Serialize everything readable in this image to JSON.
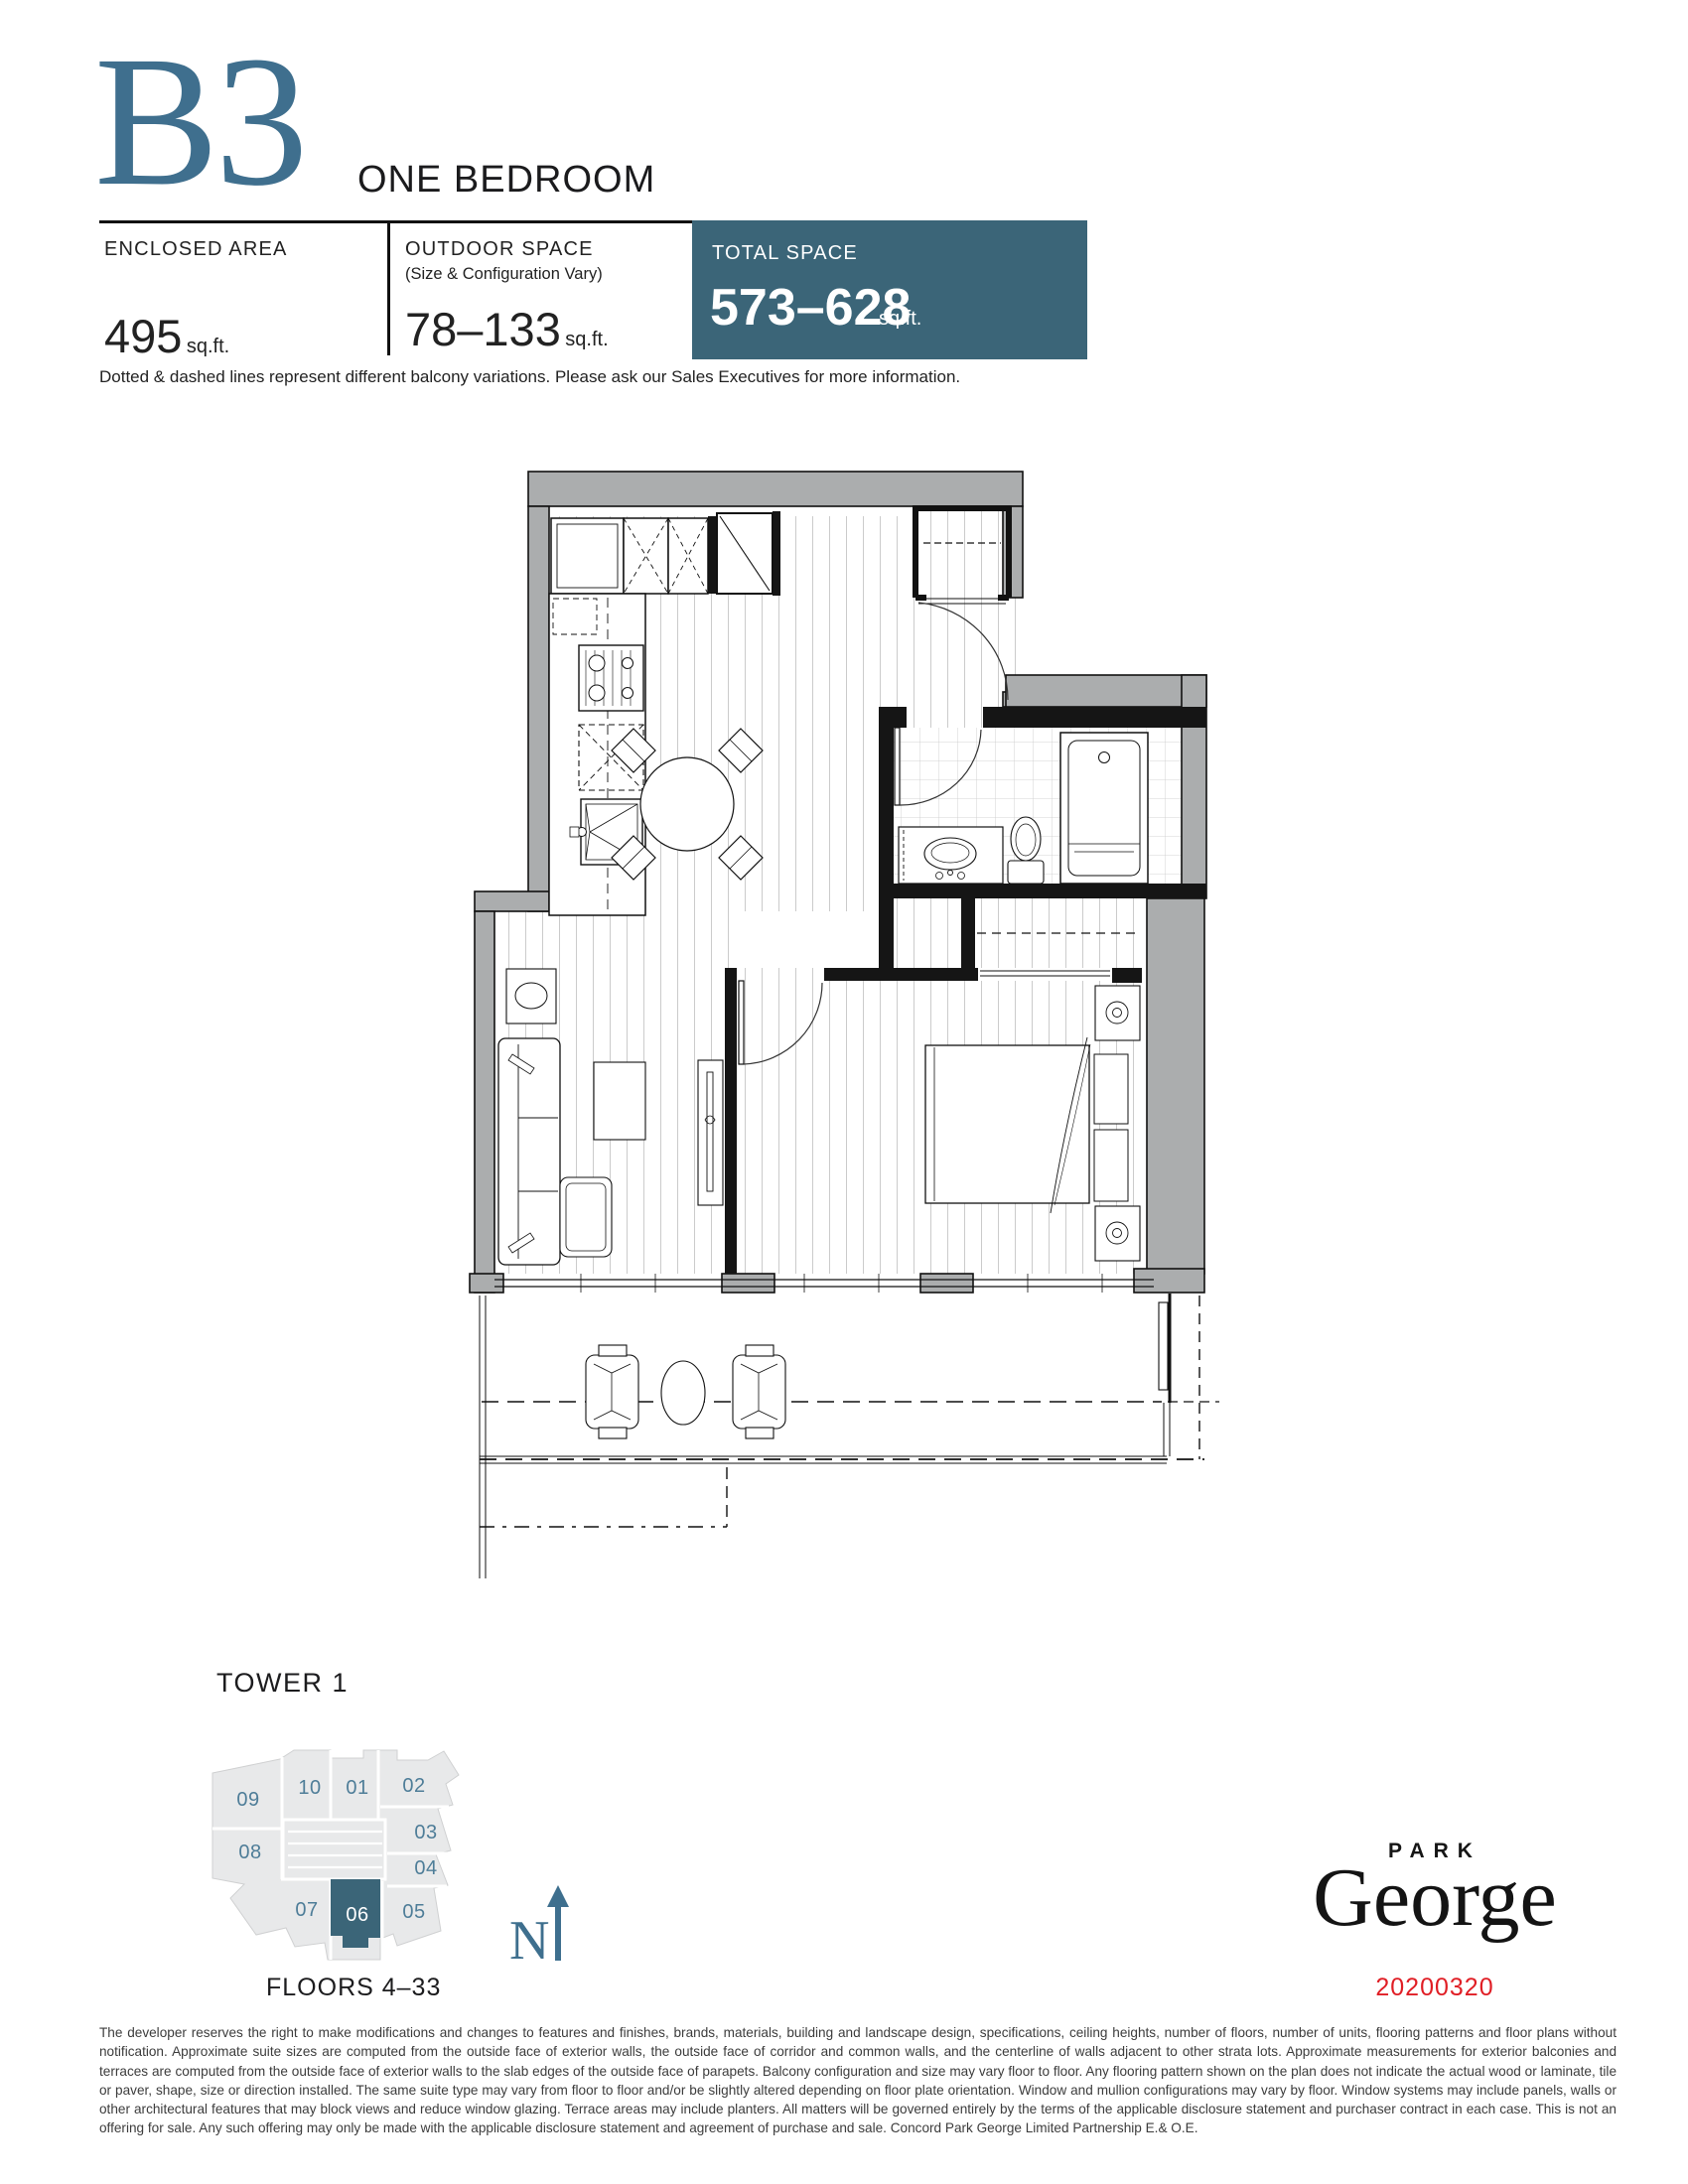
{
  "header": {
    "plan_code": "B3",
    "plan_name": "ONE BEDROOM"
  },
  "stats": {
    "enclosed": {
      "label": "ENCLOSED AREA",
      "value": "495",
      "unit": "sq.ft."
    },
    "outdoor": {
      "label": "OUTDOOR SPACE",
      "sublabel": "(Size & Configuration Vary)",
      "value": "78–133",
      "unit": "sq.ft."
    },
    "total": {
      "label": "TOTAL SPACE",
      "value": "573–628",
      "unit": "sq.ft."
    }
  },
  "note": "Dotted & dashed lines represent different balcony variations. Please ask our Sales Executives for more information.",
  "keyplate": {
    "title": "TOWER 1",
    "floors": "FLOORS 4–33",
    "compass": "N",
    "highlight_unit": "06",
    "units": [
      {
        "id": "09"
      },
      {
        "id": "10"
      },
      {
        "id": "01"
      },
      {
        "id": "02"
      },
      {
        "id": "03"
      },
      {
        "id": "04"
      },
      {
        "id": "08"
      },
      {
        "id": "07"
      },
      {
        "id": "06"
      },
      {
        "id": "05"
      }
    ]
  },
  "brand": {
    "park": "PARK",
    "george": "George",
    "date": "20200320"
  },
  "disclaimer": "The developer reserves the right to make modifications and changes to features and finishes, brands, materials, building and landscape design, specifications, ceiling heights, number of floors, number of units, flooring patterns and floor plans without notification. Approximate suite sizes are computed from the outside face of exterior walls, the outside face of corridor and common walls, and the centerline of walls adjacent to other strata lots. Approximate measurements for exterior balconies and terraces are computed from the outside face of exterior walls to the slab edges of the outside face of parapets. Balcony configuration and size may vary floor to floor. Any flooring pattern shown on the plan does not indicate the actual wood or laminate, tile or paver, shape, size or direction installed. The same suite type may vary from floor to floor and/or be slightly altered depending on floor plate orientation. Window and mullion configurations may vary by floor. Window systems may include panels, walls or other architectural features that may block views and reduce window glazing. Terrace areas may include planters. All matters will be governed entirely by the terms of the applicable disclosure statement and purchaser contract in each case. This is not an offering for sale. Any such offering may only be made with the applicable disclosure statement and agreement of purchase and sale. Concord Park George Limited Partnership E.& O.E.",
  "colors": {
    "accent_box": "#3B6578",
    "accent_plan_code": "#3F6F8E",
    "accent_unit_numbers": "#4E7D98",
    "date_red": "#E01E25",
    "wall_gray": "#ABADAE"
  }
}
